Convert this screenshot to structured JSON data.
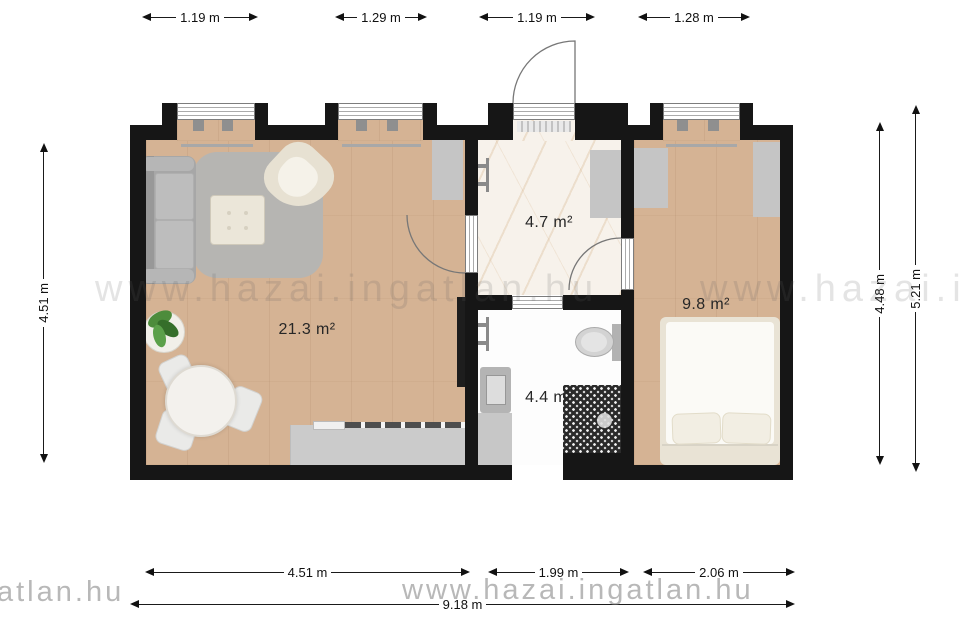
{
  "rooms": {
    "living": "21.3 m²",
    "hall": "4.7 m²",
    "bath": "4.4 m²",
    "bedroom": "9.8 m²"
  },
  "dims": {
    "top": [
      "1.19 m",
      "1.29 m",
      "1.19 m",
      "1.28 m"
    ],
    "bottom": [
      "4.51 m",
      "1.99 m",
      "2.06 m"
    ],
    "total": "9.18 m",
    "left": "4.51 m",
    "right_inner": "4.48 m",
    "right_outer": "5.21 m"
  },
  "watermark": {
    "full": "www.hazai.ingatlan.hu",
    "partial": "atlan.hu"
  },
  "colors": {
    "wall": "#161616",
    "wood_floor": "#d5b394",
    "marble_floor": "#f7f2eb",
    "furniture_gray": "#c5c5c5"
  }
}
